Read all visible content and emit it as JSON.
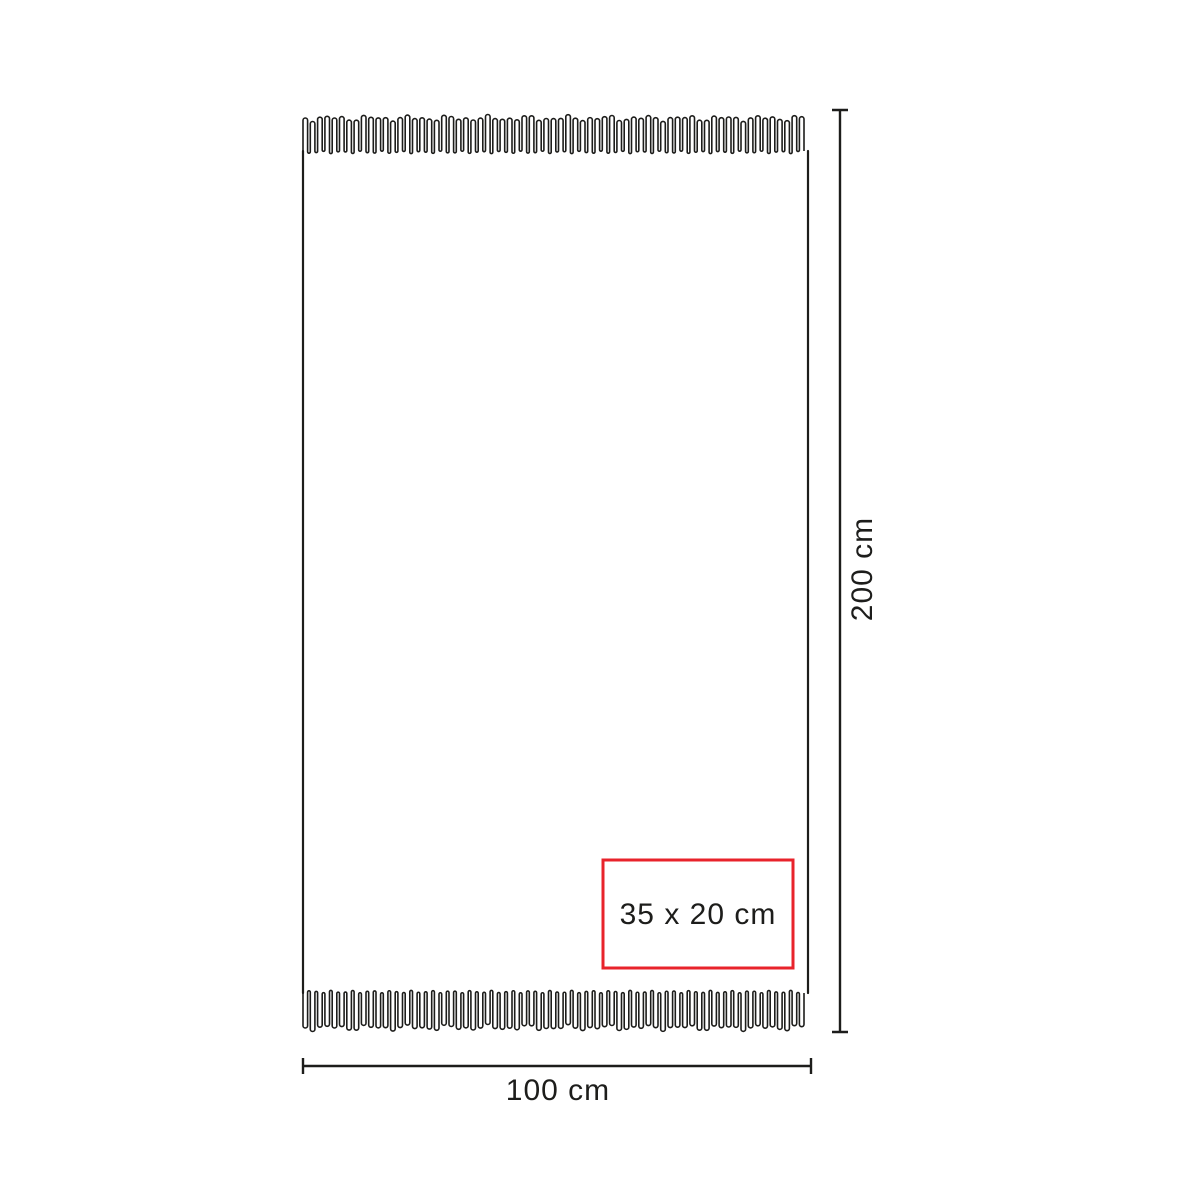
{
  "canvas": {
    "background": "#ffffff",
    "ink": "#1d1d1b"
  },
  "diagram": {
    "name": "towel-dimension-diagram",
    "height_dimension": {
      "label": "200 cm"
    },
    "width_dimension": {
      "label": "100 cm"
    },
    "print_area": {
      "label": "35 x 20 cm",
      "border_color": "#e8232b"
    }
  }
}
